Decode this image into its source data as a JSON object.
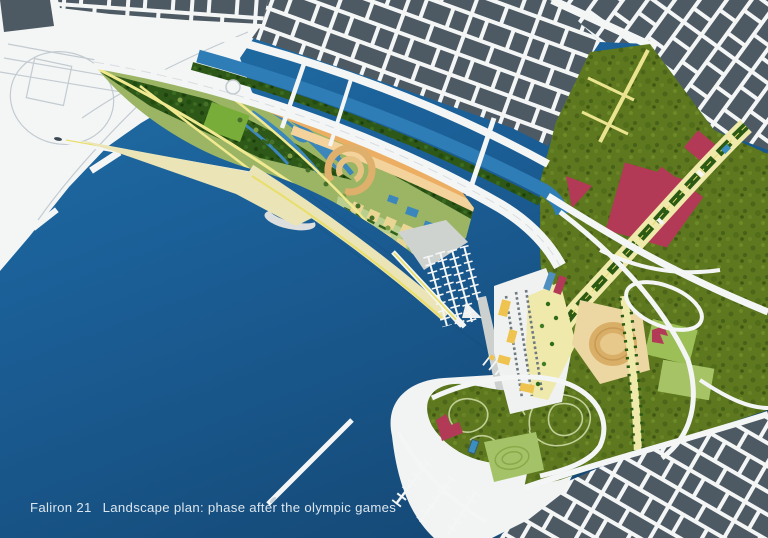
{
  "title": "Faliron 21 landscape plan",
  "caption": {
    "project": "Faliron 21",
    "description": "Landscape plan: phase after the olympic games"
  },
  "colors": {
    "water_top": "#2170a8",
    "water_mid": "#1b5f97",
    "water_deep": "#154a78",
    "city_block": "#4d5a64",
    "street_white": "#f4f6f6",
    "road_line": "#c3cbd0",
    "canal_blue": "#2f7db6",
    "wetland_blue": "#3b86bb",
    "park_green": "#9cb565",
    "tree_dark": "#2e5818",
    "olive_green": "#5d781e",
    "lawn_light": "#b9cf8d",
    "sports_green": "#79ad3a",
    "band_orange": "#ecae63",
    "band_tan": "#f3d29b",
    "beach_sand": "#ebe4b6",
    "path_yellow": "#f0e98f",
    "esplanade_cream": "#efeaa9",
    "building_red": "#b23a56",
    "stadium_tan": "#d9ae67",
    "boat_yellow": "#eec34f",
    "boat_orange": "#e09a3e",
    "pool_blue": "#3a8fc0",
    "quay_gray": "#cfd3d0",
    "crescent_gray": "#dcdfdd",
    "caption_text": "#dce6ee"
  },
  "features": [
    "harbor-water",
    "port-docks",
    "city-grid",
    "canal",
    "coastal-park",
    "wetland-forest",
    "community-gardens",
    "amphitheater",
    "beach",
    "marina",
    "crescent-breakwater",
    "olympic-sports-halls",
    "esplanade",
    "stadium",
    "botanical-garden",
    "peninsula-park",
    "highway-interchange"
  ]
}
